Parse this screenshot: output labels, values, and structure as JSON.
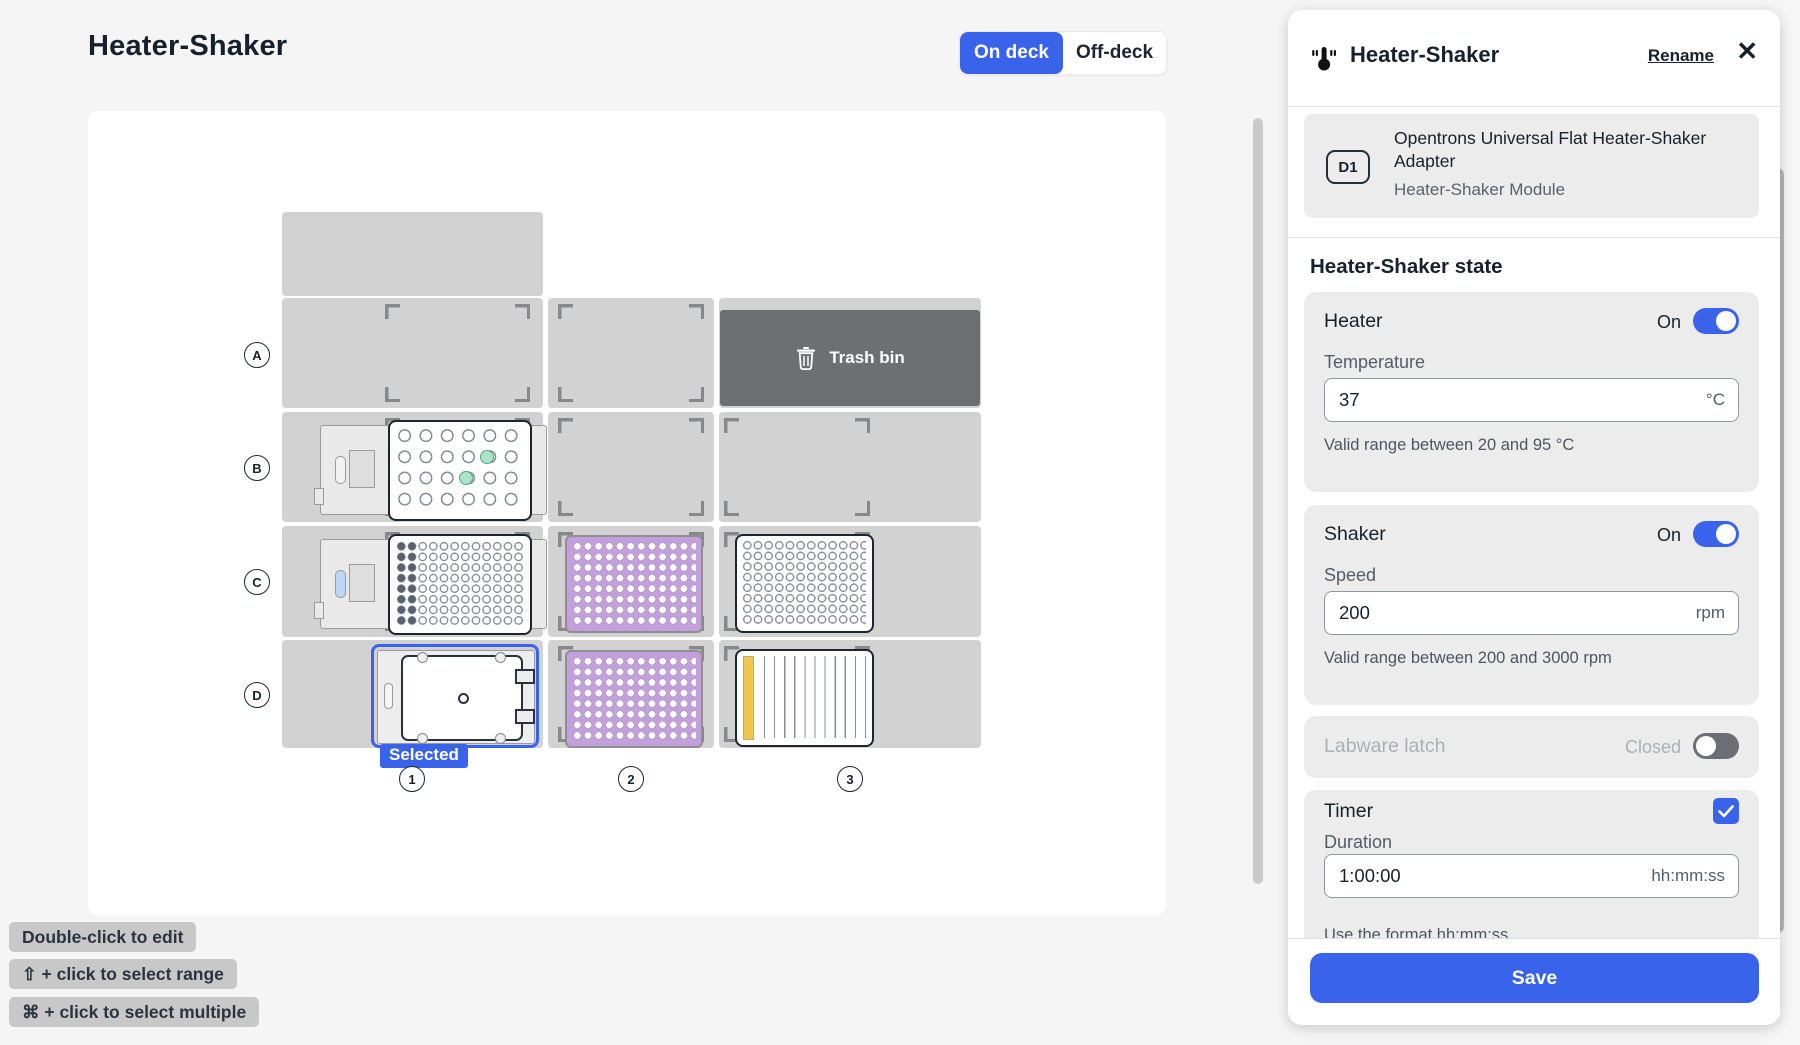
{
  "page": {
    "title": "Heater-Shaker"
  },
  "view_toggle": {
    "on_deck": "On deck",
    "off_deck": "Off-deck"
  },
  "deck": {
    "row_labels": [
      "A",
      "B",
      "C",
      "D"
    ],
    "column_labels": [
      "1",
      "2",
      "3"
    ],
    "trash_label": "Trash bin",
    "selected_label": "Selected"
  },
  "hints": [
    "Double-click to edit",
    "⇧ + click to select range",
    "⌘ + click to select multiple"
  ],
  "panel": {
    "title": "Heater-Shaker",
    "rename_label": "Rename",
    "close_glyph": "✕",
    "module_card": {
      "slot": "D1",
      "labware_name": "Opentrons Universal Flat Heater-Shaker Adapter",
      "module_name": "Heater-Shaker Module"
    },
    "state_heading": "Heater-Shaker state",
    "heater": {
      "label": "Heater",
      "status": "On",
      "field_label": "Temperature",
      "value": "37",
      "unit": "°C",
      "caption": "Valid range between 20 and 95 °C"
    },
    "shaker": {
      "label": "Shaker",
      "status": "On",
      "field_label": "Speed",
      "value": "200",
      "unit": "rpm",
      "caption": "Valid range between 200 and 3000 rpm"
    },
    "latch": {
      "label": "Labware latch",
      "status": "Closed"
    },
    "timer": {
      "label": "Timer",
      "field_label": "Duration",
      "value": "1:00:00",
      "unit": "hh:mm:ss",
      "caption": "Use the format hh:mm:ss"
    },
    "save_label": "Save",
    "accent_color": "#3A63EB"
  }
}
